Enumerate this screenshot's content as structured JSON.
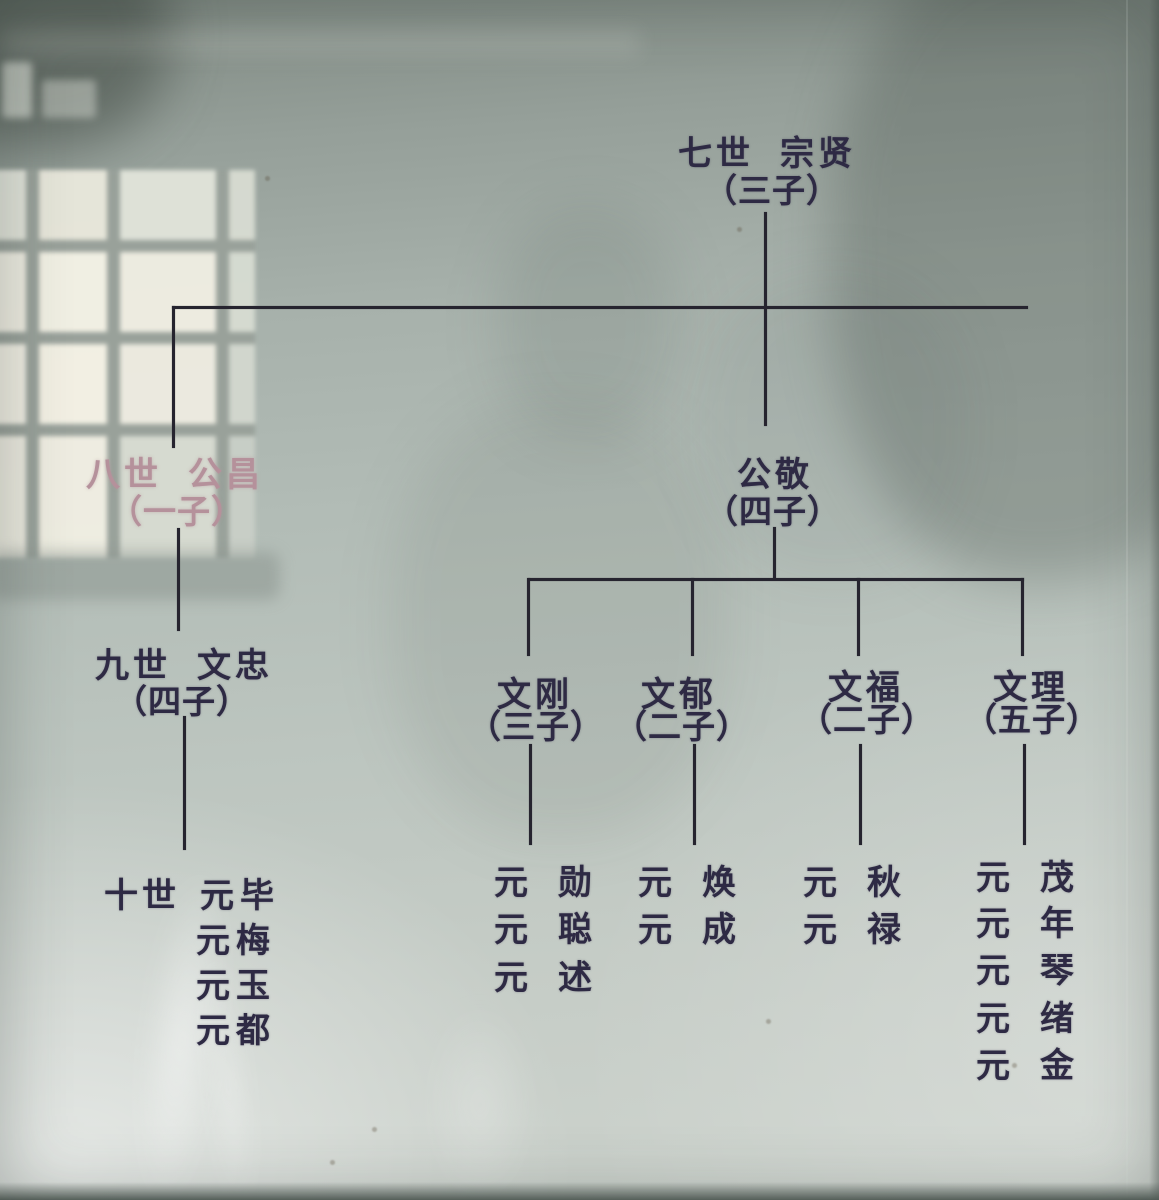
{
  "palette": {
    "ink": "#2e2a44",
    "ink_faded": "#b5919b",
    "line": "#26242f"
  },
  "tree": {
    "gen7": {
      "label": "七世",
      "name": "宗贤",
      "count": "（三子）"
    },
    "gen8": {
      "left": {
        "label": "八世",
        "name": "公昌",
        "count": "（一子）"
      },
      "right": {
        "name": "公敬",
        "count": "（四子）"
      }
    },
    "gen9": {
      "left": {
        "label": "九世",
        "name": "文忠",
        "count": "（四子）"
      },
      "branches": [
        {
          "name": "文刚",
          "count": "（三子）",
          "children": [
            "元勋",
            "元聪",
            "元述"
          ]
        },
        {
          "name": "文郁",
          "count": "（二子）",
          "children": [
            "元焕",
            "元成"
          ]
        },
        {
          "name": "文福",
          "count": "（二子）",
          "children": [
            "元秋",
            "元禄"
          ]
        },
        {
          "name": "文理",
          "count": "（五子）",
          "children": [
            "元茂",
            "元年",
            "元琴",
            "元绪",
            "元金"
          ]
        }
      ]
    },
    "gen10": {
      "label": "十世",
      "names": [
        "元毕",
        "元梅",
        "元玉",
        "元都"
      ]
    }
  }
}
